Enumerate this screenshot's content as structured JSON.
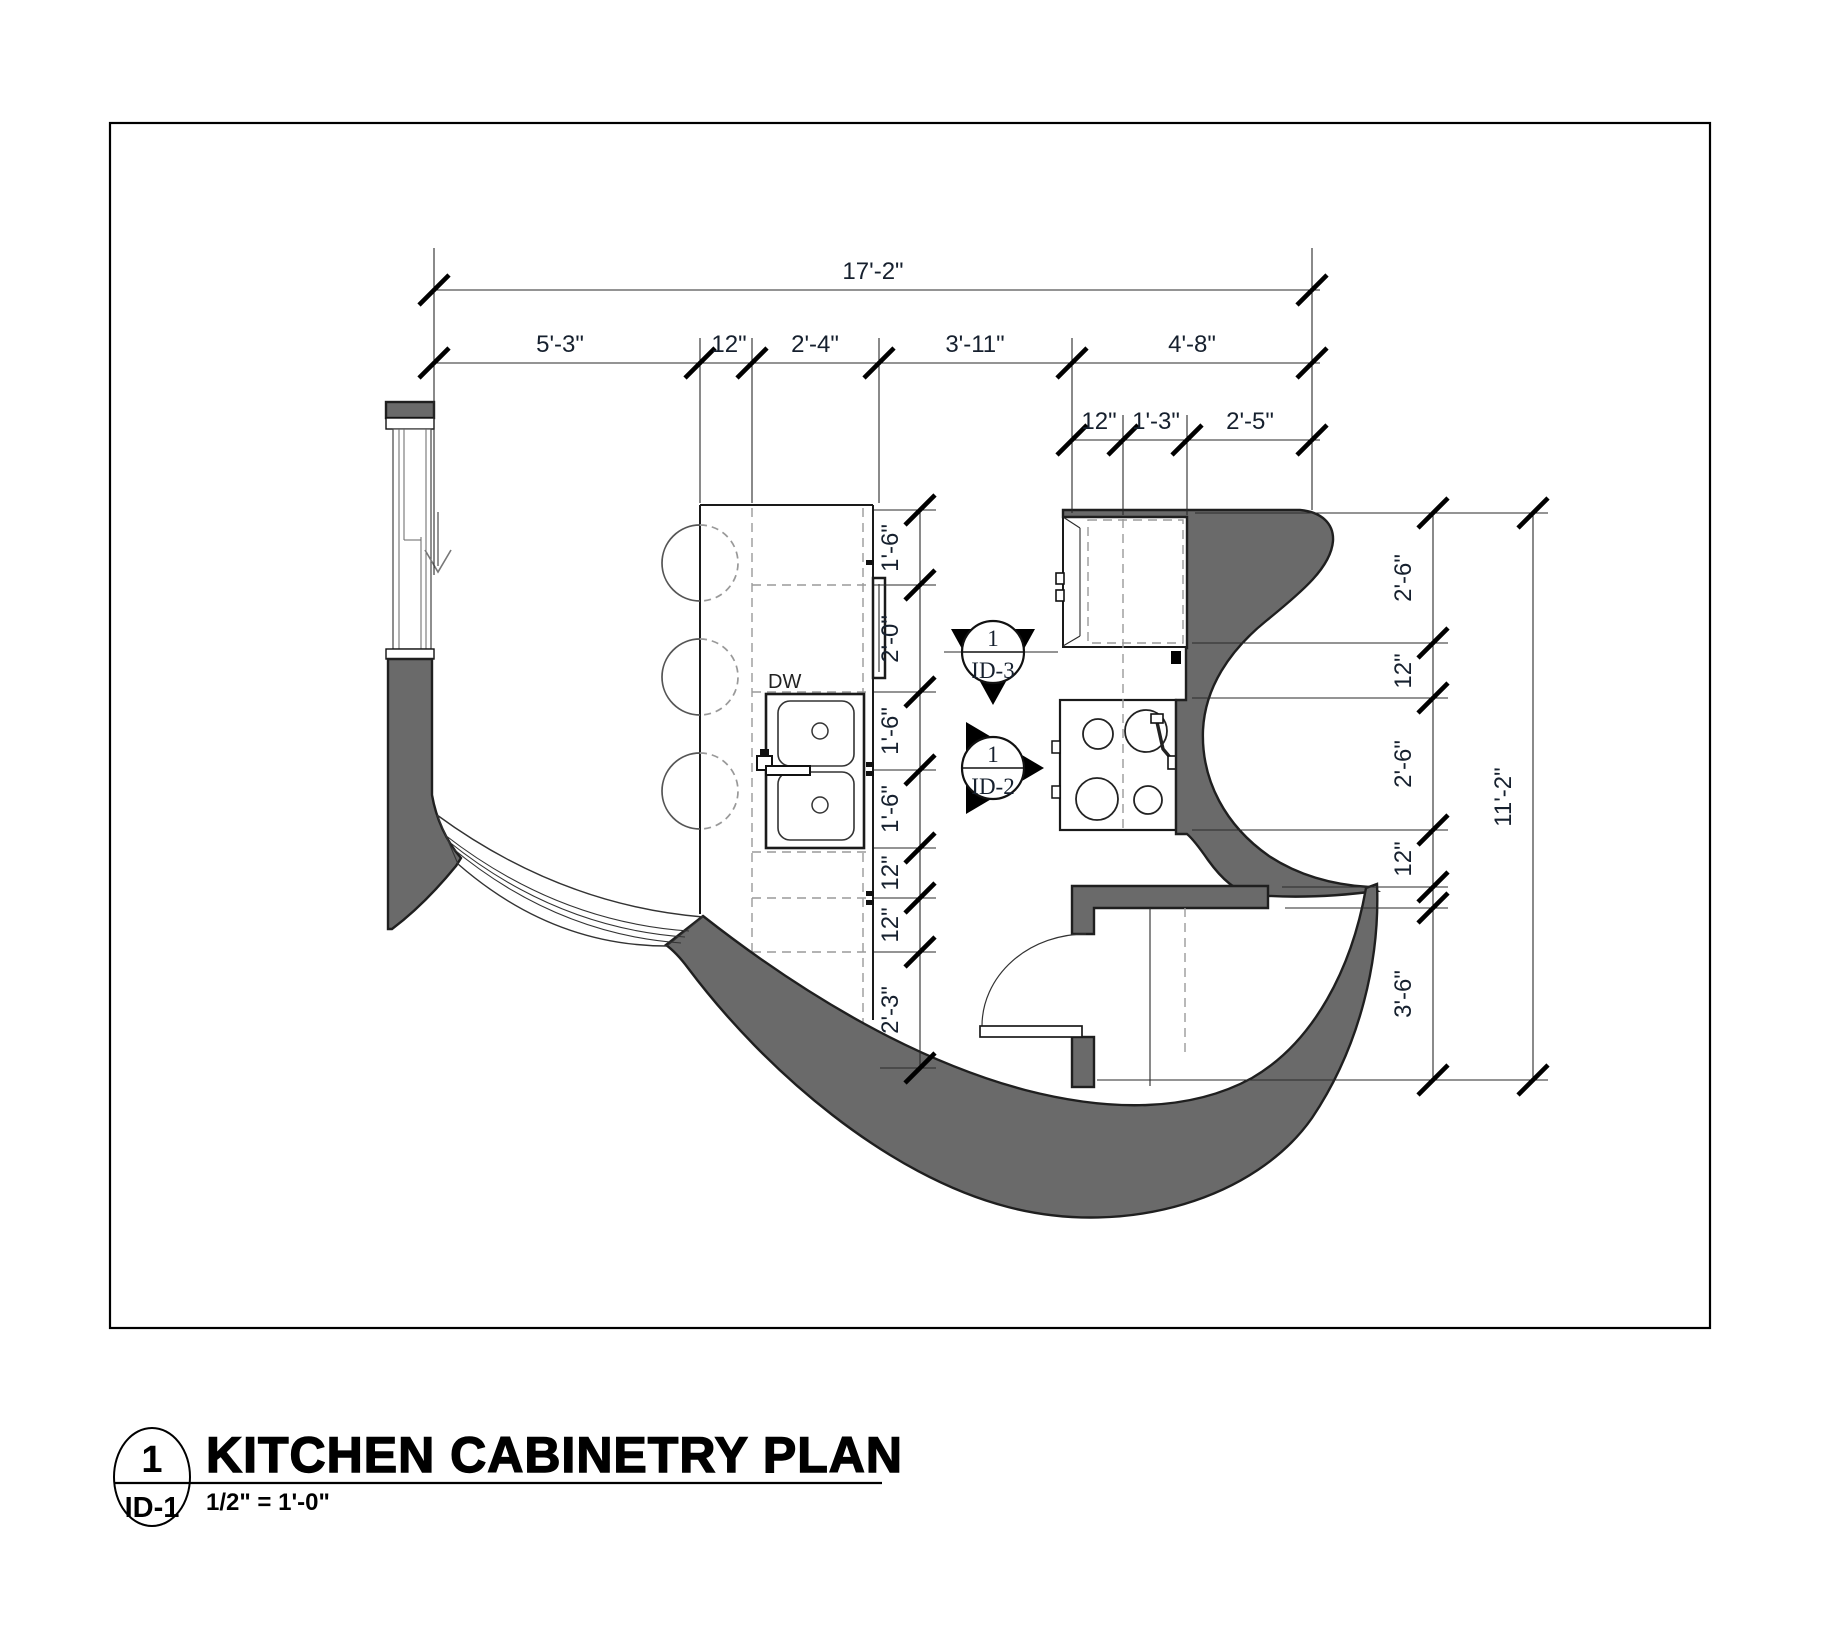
{
  "drawing": {
    "type": "floor-plan",
    "labels": {
      "dishwasher": "DW"
    },
    "callouts": [
      {
        "number": "1",
        "sheet": "ID-3"
      },
      {
        "number": "1",
        "sheet": "ID-2"
      }
    ]
  },
  "dimensions": {
    "top_total": "17'-2\"",
    "top_row": [
      "5'-3\"",
      "12\"",
      "2'-4\"",
      "3'-11\"",
      "4'-8\""
    ],
    "upper_right_row": [
      "12\"",
      "1'-3\"",
      "2'-5\""
    ],
    "island_column": [
      "1'-6\"",
      "2'-0\"",
      "1'-6\"",
      "1'-6\"",
      "12\"",
      "12\"",
      "2'-3\""
    ],
    "right_column": [
      "2'-6\"",
      "12\"",
      "2'-6\"",
      "12\"",
      "3'-6\""
    ],
    "right_total": "11'-2\""
  },
  "title_block": {
    "detail_number": "1",
    "sheet_ref": "ID-1",
    "title": "KITCHEN CABINETRY PLAN",
    "scale": "1/2\" = 1'-0\""
  },
  "colors": {
    "wall_fill": "#6a6a6a",
    "ink": "#1a1a1a",
    "annotation_text": "#16202e"
  }
}
